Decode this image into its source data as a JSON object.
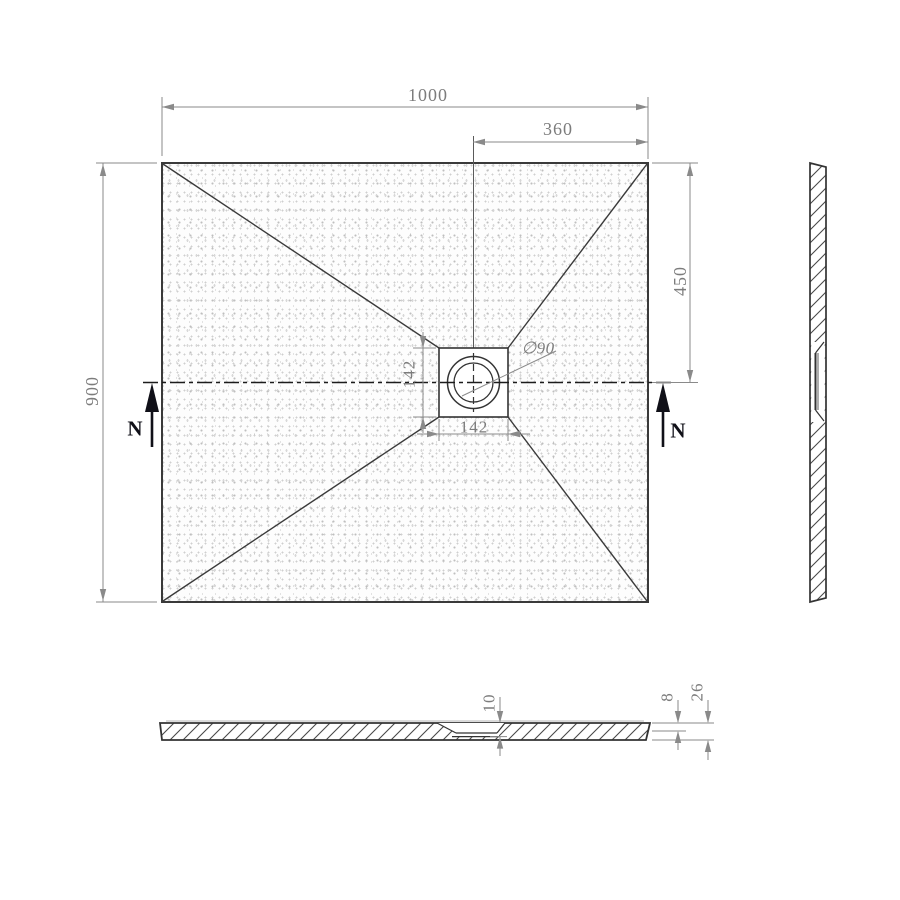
{
  "drawing": {
    "type": "technical-drawing",
    "subject": "rectangular shower tray with central square drain – plan, side elevation and cross-section",
    "colors": {
      "outline": "#3a3a3a",
      "dimension": "#8a8a8a",
      "dimension_text": "#7c7c7c",
      "section_marker": "#101018",
      "centerline": "#1c1c1c"
    },
    "plan": {
      "width_label": "1000",
      "drain_offset_x_label": "360",
      "drain_offset_y_label": "450",
      "height_label": "900",
      "drain_width_label": "142",
      "drain_height_label": "142",
      "drain_diameter_label": "∅90",
      "section_marker_left": "N",
      "section_marker_right": "N"
    },
    "section": {
      "recess_depth_label": "10",
      "edge_thickness_label": "8",
      "total_thickness_label": "26"
    }
  }
}
